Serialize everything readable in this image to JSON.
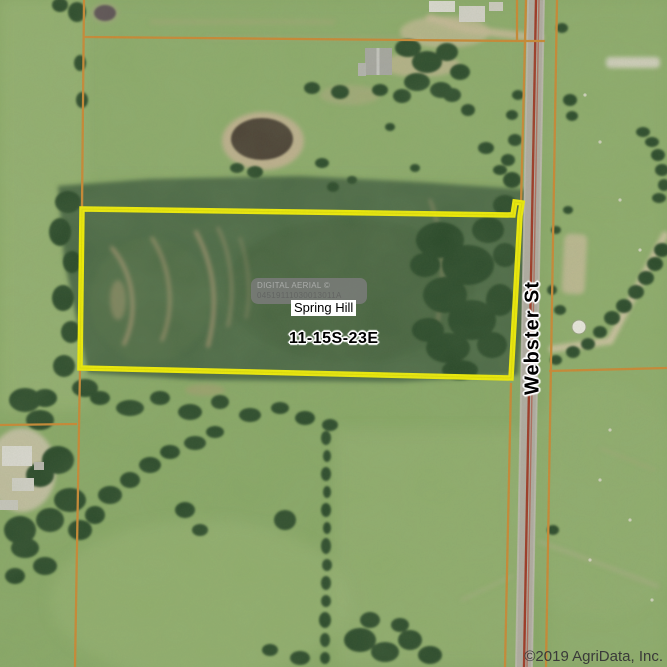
{
  "map": {
    "type": "aerial-parcel-map",
    "parcel": {
      "name": "Spring Hill",
      "section_township_range": "11-15S-23E",
      "highlight_color": "#f3ef04"
    },
    "road_label": "Webster St",
    "watermark": {
      "line1": "DIGITAL AERIAL ©",
      "line2": "04519111030013011A"
    },
    "copyright": "©2019 AgriData, Inc.",
    "colors": {
      "pasture": "#8aa968",
      "crop_field": "#4d6a46",
      "trees": "#2c4829",
      "parcel_boundary_lines": "#cc8833",
      "road_surface": "#b2aca4",
      "road_stripe": "#a03524",
      "highlight": "#f3ef04"
    }
  }
}
